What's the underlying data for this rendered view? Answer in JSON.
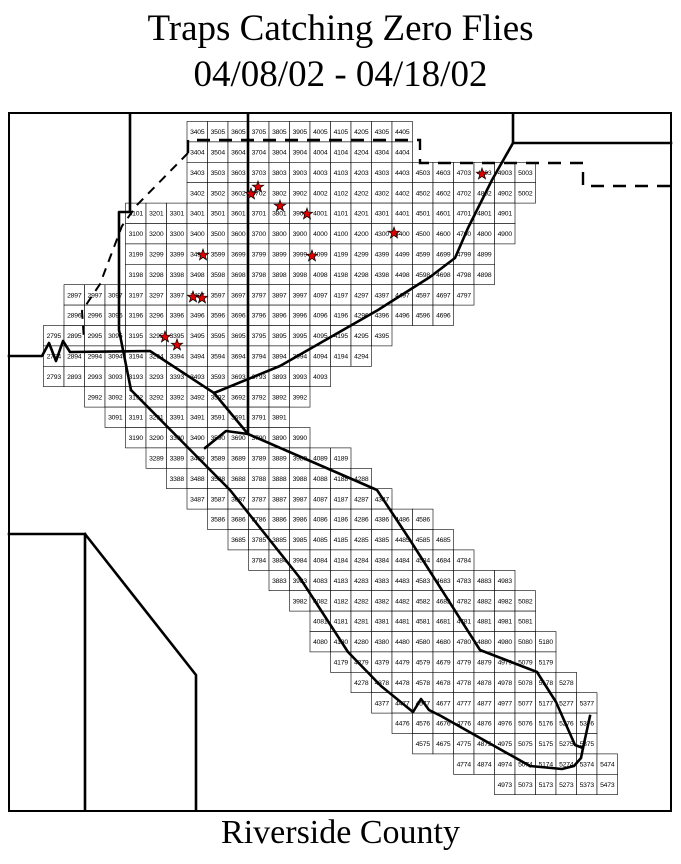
{
  "title": {
    "line1": "Traps Catching Zero Flies",
    "line2": "04/08/02 - 04/18/02"
  },
  "footer": "Riverside County",
  "colors": {
    "star_fill": "#dd0000",
    "star_outline": "#000000",
    "boundary_line": "#000000",
    "grid_line": "#000000",
    "background": "#ffffff"
  },
  "grid": {
    "rows": [
      {
        "row": "05",
        "start_col": 34,
        "cells": [
          "3405",
          "3505",
          "3605",
          "3705",
          "3805",
          "3905",
          "4005",
          "4105",
          "4205",
          "4305",
          "4405"
        ]
      },
      {
        "row": "04",
        "start_col": 34,
        "cells": [
          "3404",
          "3504",
          "3604",
          "3704",
          "3804",
          "3904",
          "4004",
          "4104",
          "4204",
          "4304",
          "4404"
        ]
      },
      {
        "row": "03",
        "start_col": 34,
        "cells": [
          "3403",
          "3503",
          "3603",
          "3703",
          "3803",
          "3903",
          "4003",
          "4103",
          "4203",
          "4303",
          "4403",
          "4503",
          "4603",
          "4703",
          "4803",
          "4903",
          "5003"
        ]
      },
      {
        "row": "02",
        "start_col": 34,
        "cells": [
          "3402",
          "3502",
          "3602",
          "3702",
          "3802",
          "3902",
          "4002",
          "4102",
          "4202",
          "4302",
          "4402",
          "4502",
          "4602",
          "4702",
          "4802",
          "4902",
          "5002"
        ]
      },
      {
        "row": "01",
        "start_col": 31,
        "cells": [
          "3101",
          "3201",
          "3301",
          "3401",
          "3501",
          "3601",
          "3701",
          "3801",
          "3901",
          "4001",
          "4101",
          "4201",
          "4301",
          "4401",
          "4501",
          "4601",
          "4701",
          "4801",
          "4901"
        ]
      },
      {
        "row": "00",
        "start_col": 31,
        "cells": [
          "3100",
          "3200",
          "3300",
          "3400",
          "3500",
          "3600",
          "3700",
          "3800",
          "3900",
          "4000",
          "4100",
          "4200",
          "4300",
          "4400",
          "4500",
          "4600",
          "4700",
          "4800",
          "4900"
        ]
      },
      {
        "row": "99",
        "start_col": 31,
        "cells": [
          "3199",
          "3299",
          "3399",
          "3499",
          "3599",
          "3699",
          "3799",
          "3899",
          "3999",
          "4099",
          "4199",
          "4299",
          "4399",
          "4499",
          "4599",
          "4699",
          "4799",
          "4899"
        ]
      },
      {
        "row": "98",
        "start_col": 31,
        "cells": [
          "3198",
          "3298",
          "3398",
          "3498",
          "3598",
          "3698",
          "3798",
          "3898",
          "3998",
          "4098",
          "4198",
          "4298",
          "4398",
          "4498",
          "4598",
          "4698",
          "4798",
          "4898"
        ]
      },
      {
        "row": "97",
        "start_col": 28,
        "cells": [
          "2897",
          "2997",
          "3097",
          "3197",
          "3297",
          "3397",
          "3497",
          "3597",
          "3697",
          "3797",
          "3897",
          "3997",
          "4097",
          "4197",
          "4297",
          "4397",
          "4497",
          "4597",
          "4697",
          "4797"
        ]
      },
      {
        "row": "96",
        "start_col": 28,
        "cells": [
          "2896",
          "2996",
          "3096",
          "3196",
          "3296",
          "3396",
          "3496",
          "3596",
          "3696",
          "3796",
          "3896",
          "3996",
          "4096",
          "4196",
          "4296",
          "4396",
          "4496",
          "4596",
          "4696"
        ]
      },
      {
        "row": "95",
        "start_col": 27,
        "cells": [
          "2795",
          "2895",
          "2995",
          "3095",
          "3195",
          "3295",
          "3395",
          "3495",
          "3595",
          "3695",
          "3795",
          "3895",
          "3995",
          "4095",
          "4195",
          "4295",
          "4395"
        ]
      },
      {
        "row": "94",
        "start_col": 27,
        "cells": [
          "2794",
          "2894",
          "2994",
          "3094",
          "3194",
          "3294",
          "3394",
          "3494",
          "3594",
          "3694",
          "3794",
          "3894",
          "3994",
          "4094",
          "4194",
          "4294"
        ]
      },
      {
        "row": "93",
        "start_col": 27,
        "cells": [
          "2793",
          "2893",
          "2993",
          "3093",
          "3193",
          "3293",
          "3393",
          "3493",
          "3593",
          "3693",
          "3793",
          "3893",
          "3993",
          "4093"
        ]
      },
      {
        "row": "92",
        "start_col": 29,
        "cells": [
          "2992",
          "3092",
          "3192",
          "3292",
          "3392",
          "3492",
          "3592",
          "3692",
          "3792",
          "3892",
          "3992"
        ]
      },
      {
        "row": "91",
        "start_col": 30,
        "cells": [
          "3091",
          "3191",
          "3291",
          "3391",
          "3491",
          "3591",
          "3691",
          "3791",
          "3891"
        ]
      },
      {
        "row": "90",
        "start_col": 31,
        "cells": [
          "3190",
          "3290",
          "3390",
          "3490",
          "3590",
          "3690",
          "3790",
          "3890",
          "3990"
        ]
      },
      {
        "row": "89",
        "start_col": 32,
        "cells": [
          "3289",
          "3389",
          "3489",
          "3589",
          "3689",
          "3789",
          "3889",
          "3989",
          "4089",
          "4189"
        ]
      },
      {
        "row": "88",
        "start_col": 33,
        "cells": [
          "3388",
          "3488",
          "3588",
          "3688",
          "3788",
          "3888",
          "3988",
          "4088",
          "4188",
          "4288"
        ]
      },
      {
        "row": "87",
        "start_col": 34,
        "cells": [
          "3487",
          "3587",
          "3687",
          "3787",
          "3887",
          "3987",
          "4087",
          "4187",
          "4287",
          "4387"
        ]
      },
      {
        "row": "86",
        "start_col": 35,
        "cells": [
          "3586",
          "3686",
          "3786",
          "3886",
          "3986",
          "4086",
          "4186",
          "4286",
          "4386",
          "4486",
          "4586"
        ]
      },
      {
        "row": "85",
        "start_col": 36,
        "cells": [
          "3685",
          "3785",
          "3885",
          "3985",
          "4085",
          "4185",
          "4285",
          "4385",
          "4485",
          "4585",
          "4685"
        ]
      },
      {
        "row": "84",
        "start_col": 37,
        "cells": [
          "3784",
          "3884",
          "3984",
          "4084",
          "4184",
          "4284",
          "4384",
          "4484",
          "4584",
          "4684",
          "4784"
        ]
      },
      {
        "row": "83",
        "start_col": 38,
        "cells": [
          "3883",
          "3983",
          "4083",
          "4183",
          "4283",
          "4383",
          "4483",
          "4583",
          "4683",
          "4783",
          "4883",
          "4983"
        ]
      },
      {
        "row": "82",
        "start_col": 39,
        "cells": [
          "3982",
          "4082",
          "4182",
          "4282",
          "4382",
          "4482",
          "4582",
          "4682",
          "4782",
          "4882",
          "4982",
          "5082"
        ]
      },
      {
        "row": "81",
        "start_col": 40,
        "cells": [
          "4081",
          "4181",
          "4281",
          "4381",
          "4481",
          "4581",
          "4681",
          "4781",
          "4881",
          "4981",
          "5081"
        ]
      },
      {
        "row": "80",
        "start_col": 40,
        "cells": [
          "4080",
          "4180",
          "4280",
          "4380",
          "4480",
          "4580",
          "4680",
          "4780",
          "4880",
          "4980",
          "5080",
          "5180"
        ]
      },
      {
        "row": "79",
        "start_col": 41,
        "cells": [
          "4179",
          "4279",
          "4379",
          "4479",
          "4579",
          "4679",
          "4779",
          "4879",
          "4979",
          "5079",
          "5179"
        ]
      },
      {
        "row": "78",
        "start_col": 42,
        "cells": [
          "4278",
          "4378",
          "4478",
          "4578",
          "4678",
          "4778",
          "4878",
          "4978",
          "5078",
          "5178",
          "5278"
        ]
      },
      {
        "row": "77",
        "start_col": 43,
        "cells": [
          "4377",
          "4477",
          "4577",
          "4677",
          "4777",
          "4877",
          "4977",
          "5077",
          "5177",
          "5277",
          "5377"
        ]
      },
      {
        "row": "76",
        "start_col": 44,
        "cells": [
          "4476",
          "4576",
          "4676",
          "4776",
          "4876",
          "4976",
          "5076",
          "5176",
          "5276",
          "5376"
        ]
      },
      {
        "row": "75",
        "start_col": 45,
        "cells": [
          "4575",
          "4675",
          "4775",
          "4875",
          "4975",
          "5075",
          "5175",
          "5275",
          "5375"
        ]
      },
      {
        "row": "74",
        "start_col": 47,
        "cells": [
          "4774",
          "4874",
          "4974",
          "5074",
          "5174",
          "5274",
          "5374",
          "5474"
        ]
      },
      {
        "row": "73",
        "start_col": 49,
        "cells": [
          "4973",
          "5073",
          "5173",
          "5273",
          "5373",
          "5473"
        ]
      }
    ]
  },
  "stars": [
    {
      "x": 258,
      "y": 187,
      "near_cell": "3702"
    },
    {
      "x": 251,
      "y": 194,
      "near_cell": "3702"
    },
    {
      "x": 280,
      "y": 206,
      "near_cell": "3801"
    },
    {
      "x": 307,
      "y": 214,
      "near_cell": "3901"
    },
    {
      "x": 394,
      "y": 233,
      "near_cell": "4400"
    },
    {
      "x": 482,
      "y": 174,
      "near_cell": "4803"
    },
    {
      "x": 203,
      "y": 255,
      "near_cell": "3499"
    },
    {
      "x": 312,
      "y": 256,
      "near_cell": "3999"
    },
    {
      "x": 193,
      "y": 297,
      "near_cell": "3497"
    },
    {
      "x": 202,
      "y": 298,
      "near_cell": "3497"
    },
    {
      "x": 165,
      "y": 337,
      "near_cell": "3295"
    },
    {
      "x": 177,
      "y": 345,
      "near_cell": "3395"
    }
  ]
}
